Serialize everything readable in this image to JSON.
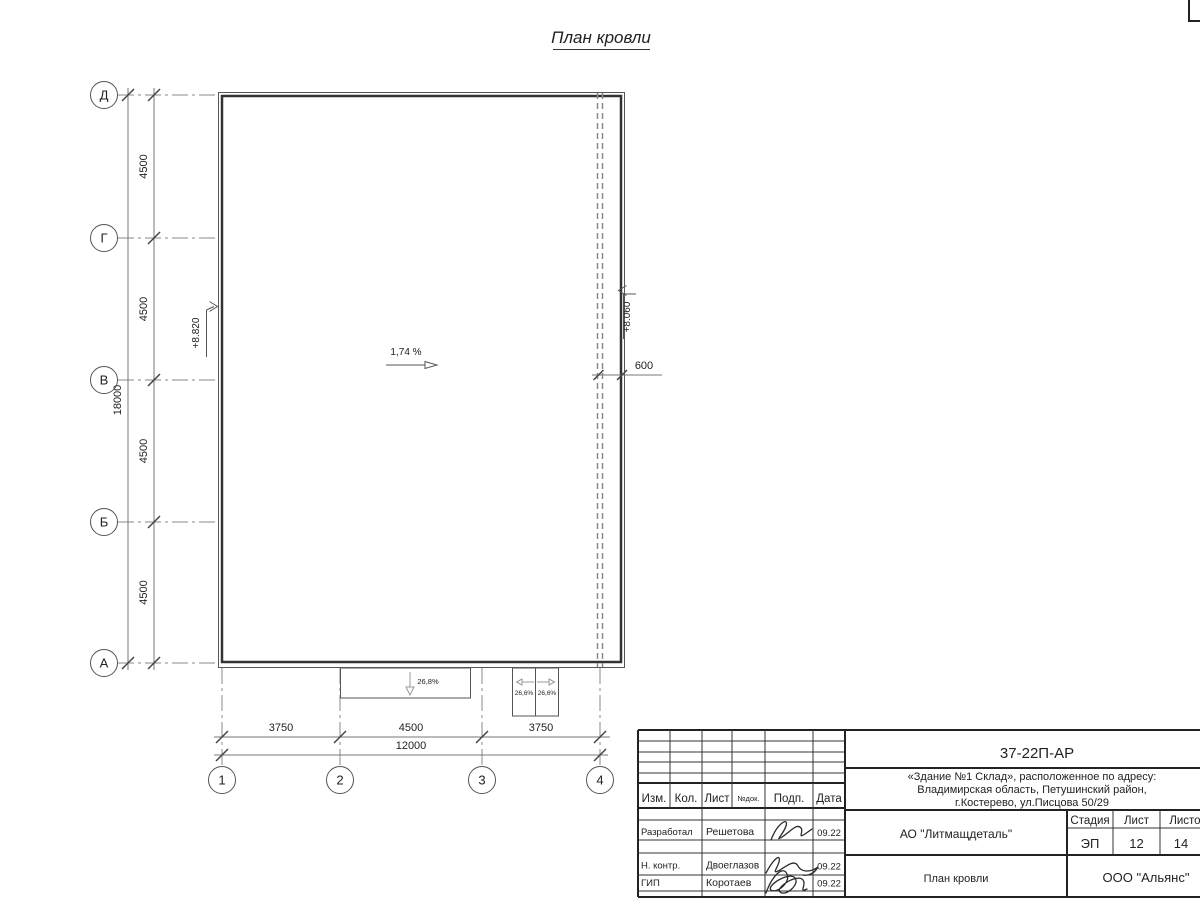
{
  "title": "План кровли",
  "colors": {
    "ink": "#333333",
    "background": "#ffffff"
  },
  "axes": {
    "rows": [
      "Д",
      "Г",
      "В",
      "Б",
      "А"
    ],
    "cols": [
      "1",
      "2",
      "3",
      "4"
    ]
  },
  "dimensions": {
    "row_spacing": [
      "4500",
      "4500",
      "4500",
      "4500"
    ],
    "row_total": "18000",
    "col_spacing": [
      "3750",
      "4500",
      "3750"
    ],
    "col_total": "12000",
    "parapet_offset": "600"
  },
  "annotations": {
    "slope_main": "1,74 %",
    "elevation_left": "+8.820",
    "elevation_right": "+8.060",
    "canopy_slope": "26,8%",
    "block_slope_left": "26,6%",
    "block_slope_right": "26,6%"
  },
  "title_block": {
    "doc_number": "37-22П-АР",
    "address_line1": "«Здание №1 Склад», расположенное по адресу:",
    "address_line2": "Владимирская область, Петушинский район,",
    "address_line3": "г.Костерево, ул.Писцова 50/29",
    "client": "АО \"Литмащдеталь\"",
    "sheet_title": "План кровли",
    "company": "ООО \"Альянс\"",
    "stage_label": "Стадия",
    "stage": "ЭП",
    "sheet_label": "Лист",
    "sheet": "12",
    "sheets_label": "Листов",
    "sheets": "14",
    "header": {
      "izm": "Изм.",
      "kol": "Кол.",
      "list": "Лист",
      "ndok": "№док.",
      "podp": "Подп.",
      "data": "Дата"
    },
    "roles": [
      {
        "role": "Разработал",
        "name": "Решетова",
        "date": "09.22"
      },
      {
        "role": "Н. контр.",
        "name": "Двоеглазов",
        "date": "09.22"
      },
      {
        "role": "ГИП",
        "name": "Коротаев",
        "date": "09.22"
      }
    ]
  }
}
